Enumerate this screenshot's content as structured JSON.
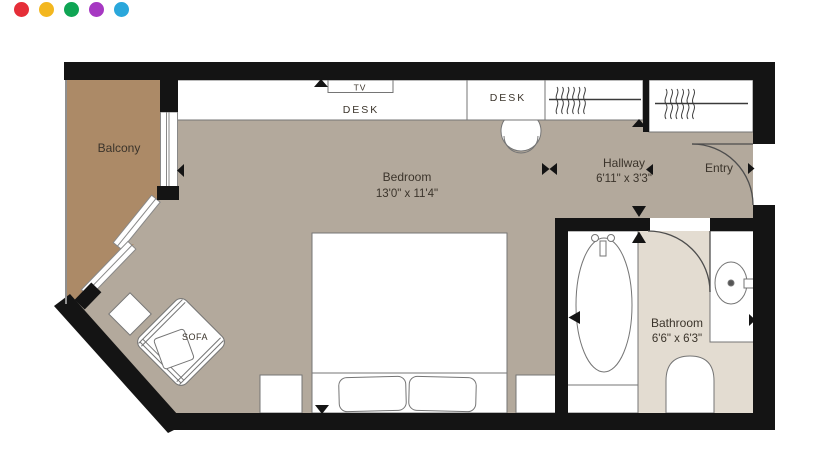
{
  "logo": {
    "dots": [
      {
        "name": "dot-red",
        "color": "#e52e38"
      },
      {
        "name": "dot-yellow",
        "color": "#f3b71f"
      },
      {
        "name": "dot-green",
        "color": "#0fa554"
      },
      {
        "name": "dot-purple",
        "color": "#a638c2"
      },
      {
        "name": "dot-blue",
        "color": "#2aa7db"
      }
    ]
  },
  "floorplan": {
    "colors": {
      "wall": "#141414",
      "bedroom_floor": "#b3a99c",
      "balcony_floor": "#ac8a67",
      "bathroom_floor": "#e3dcd1",
      "furniture_fill": "#ffffff"
    },
    "rooms": {
      "balcony": {
        "label": "Balcony"
      },
      "bedroom": {
        "label": "Bedroom",
        "dimensions": "13'0\" x 11'4\""
      },
      "hallway": {
        "label": "Hallway",
        "dimensions": "6'11\" x 3'3\""
      },
      "entry": {
        "label": "Entry"
      },
      "bathroom": {
        "label": "Bathroom",
        "dimensions": "6'6\" x 6'3\""
      }
    },
    "labels": {
      "tv": "TV",
      "desk_window": "DESK",
      "desk_hallway": "DESK",
      "sofa": "SOFA"
    }
  }
}
